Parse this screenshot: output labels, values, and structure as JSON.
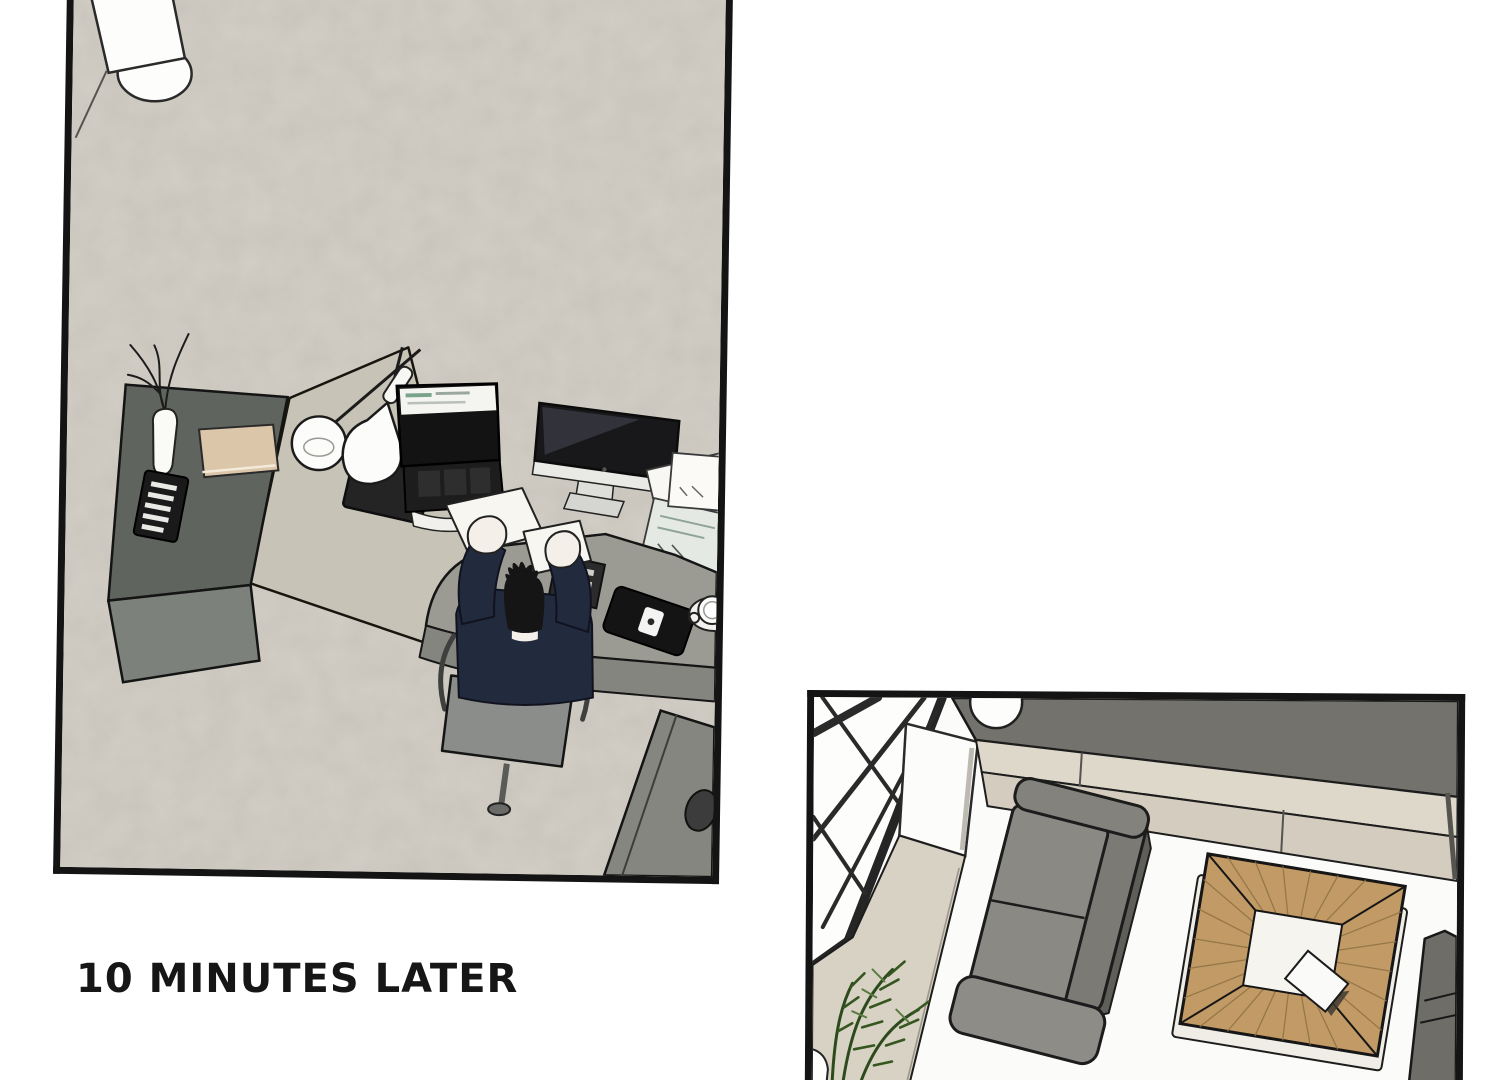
{
  "page": {
    "type": "webtoon comic page",
    "background": "#ffffff",
    "panel_border_color": "#141414"
  },
  "caption": {
    "text": "10 MINUTES LATER",
    "color": "#161616"
  },
  "panel1": {
    "title": "overhead office desk scene",
    "floor_color": "#c9c4bb",
    "objects": {
      "pillar": "white floor pillar with round base",
      "cabinet": "dark gray side cabinet",
      "vase": "white vase with dry branches",
      "book": "beige book",
      "stripebox": "black box with white stripes",
      "tablet": "black tablet",
      "lamp": "white double-shade desk lamp",
      "laptop": "open laptop showing a white browser window",
      "imac": "iMac monitor with dark screen",
      "papers": "scattered white papers",
      "keyboard": "compact keyboard with white keys",
      "phone": "black smartphone with white logo",
      "mug": "white coffee mug on saucer",
      "person": "man in navy sweater holding papers up",
      "chair": "gray office chair on a pole base",
      "desk": "L-shaped gray office desk"
    }
  },
  "panel2": {
    "title": "living room scene",
    "floor_color": "#fbfbf9",
    "objects": {
      "window": "floor-to-ceiling window with black braces",
      "wallpanel": "white wall panel",
      "walkway": "beige walkway strip",
      "bench": "dark gray bench along the wall",
      "sphere": "white round lamp",
      "ledges": "beige ledge strips",
      "sofa": "gray two-seat sofa",
      "table": "square wooden coffee table with white center",
      "card": "white booklet on the table",
      "sidesofa": "gray sofa at the right edge",
      "plant": "green fern plant",
      "pot": "white plant pot"
    }
  },
  "colors": {
    "floor1": "#c9c4bb",
    "cabinet_top": "#60645e",
    "cabinet_front": "#7c817b",
    "light_desk": "#c7c3b6",
    "person_desk": "#9b9b93",
    "partition": "#8e8f88",
    "sweater_navy": "#222a3d",
    "sofa_gray": "#8a8984",
    "wood_tan": "#c29a66",
    "walkway_beige": "#d8d2c5",
    "bench_dark": "#73726c",
    "plant_green": "#35571f"
  }
}
